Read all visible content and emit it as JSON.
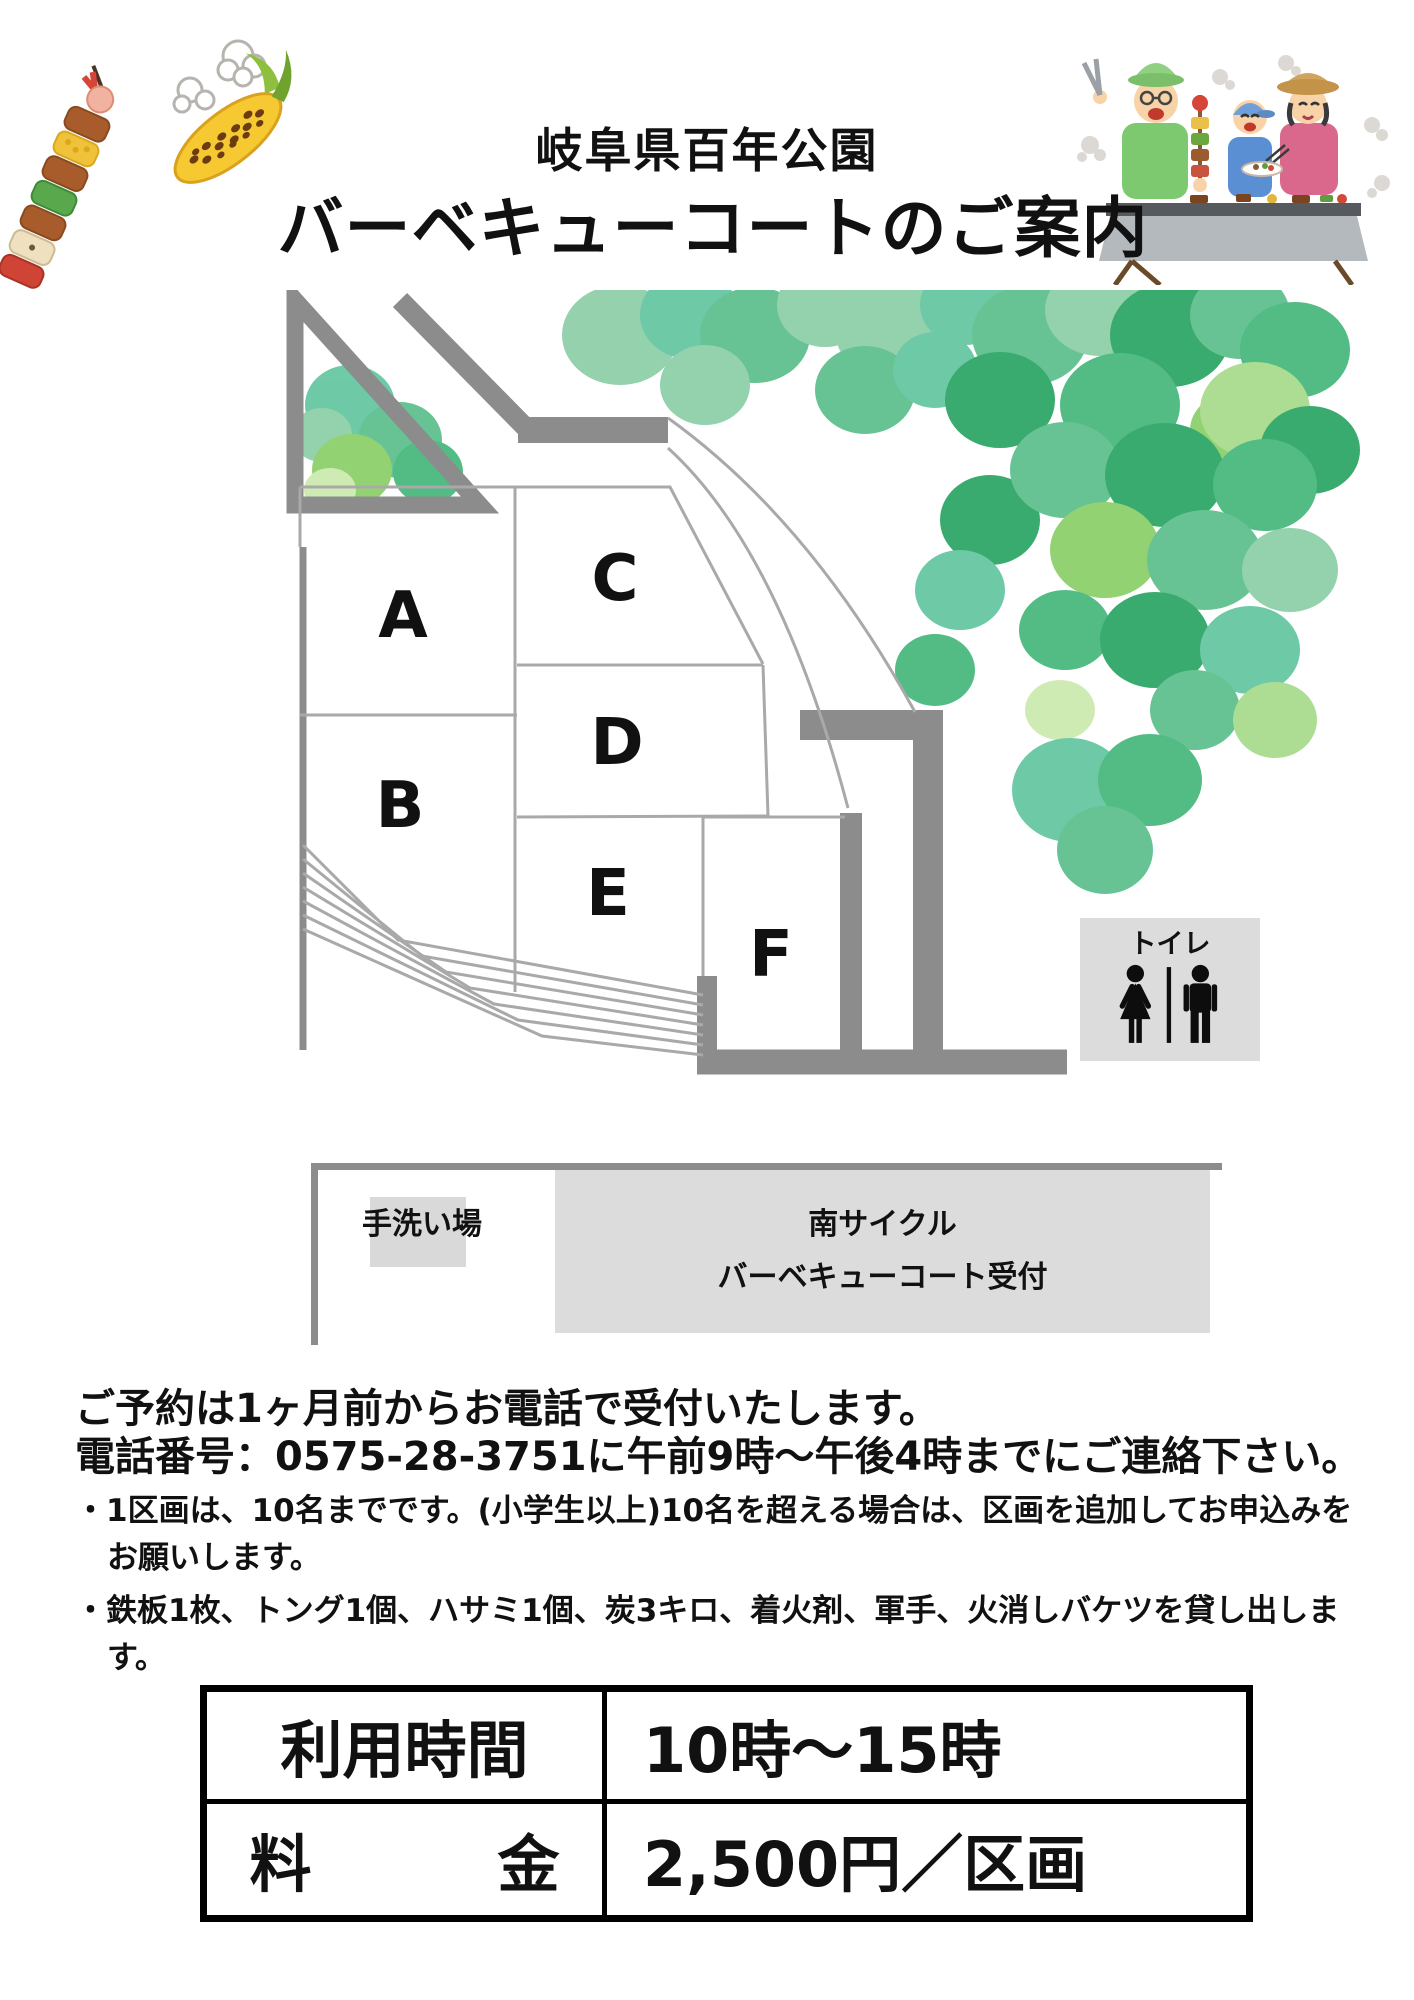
{
  "header": {
    "park_name": "岐阜県百年公園",
    "title": "バーベキューコートのご案内"
  },
  "map": {
    "plot_labels": [
      "A",
      "B",
      "C",
      "D",
      "E",
      "F"
    ],
    "toilet": {
      "label": "トイレ"
    },
    "handwash_label": "手洗い場",
    "reception": {
      "line1": "南サイクル",
      "line2": "バーベキューコート受付"
    },
    "colors": {
      "road": "#8c8c8c",
      "plot_border": "#a9a9a9",
      "sign_bg": "#dcdcdc",
      "tree_palette": [
        "#8fcfa9",
        "#5fc08f",
        "#2fa768",
        "#49b97e",
        "#8ed06c",
        "#a9dc8e",
        "#66c7a2"
      ]
    }
  },
  "notes": {
    "line1": "ご予約は1ヶ月前からお電話で受付いたします。",
    "line2": "電話番号：0575-28-3751に午前9時～午後4時までにご連絡下さい。",
    "bullets": [
      "・1区画は、10名までです。(小学生以上)10名を超える場合は、区画を追加してお申込みをお願いします。",
      "・鉄板1枚、トング1個、ハサミ1個、炭3キロ、着火剤、軍手、火消しバケツを貸し出します。"
    ]
  },
  "table": {
    "rows": [
      {
        "label": "利用時間",
        "value": "10時～15時"
      },
      {
        "label": "料　　　金",
        "value": "2,500円／区画"
      }
    ]
  }
}
